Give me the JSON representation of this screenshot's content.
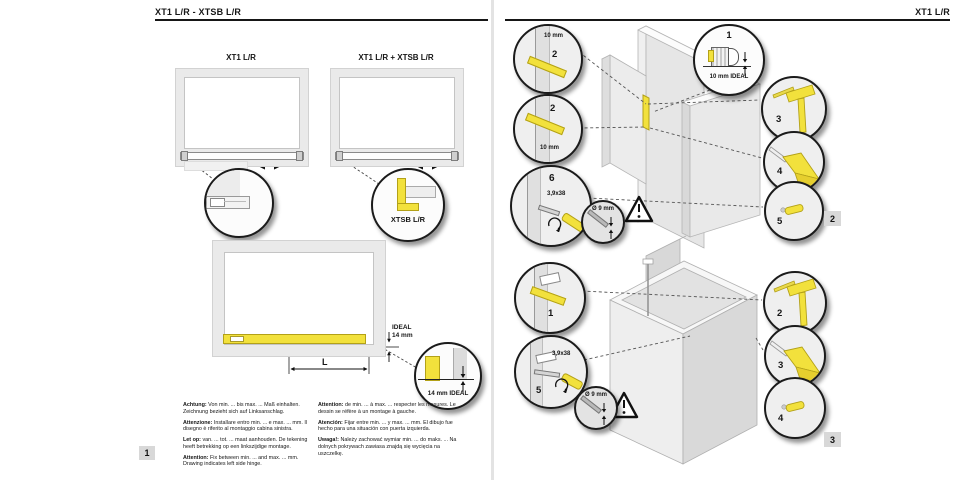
{
  "colors": {
    "accent_yellow": "#f2e13c",
    "yellow_border": "#b3a118",
    "panel_gray": "#eaeaea",
    "line": "#161616"
  },
  "left_page": {
    "header": "XT1 L/R - XTSB L/R",
    "step_number": "1",
    "figure1": {
      "title": "XT1 L/R"
    },
    "figure2": {
      "title": "XT1 L/R + XTSB L/R",
      "detail_label": "XTSB L/R"
    },
    "figure3": {
      "ideal_line1": "IDEAL",
      "ideal_line2": "14 mm",
      "length_label": "L",
      "detail_label": "14 mm IDEAL"
    },
    "notes_col1": [
      {
        "label": "Achtung:",
        "text": "Von min. ... bis max. ... Maß einhalten. Zeichnung bezieht sich auf Linksanschlag."
      },
      {
        "label": "Attenzione:",
        "text": "Installare entro min. ... e max. ... mm. Il disegno è riferito al montaggio cabina sinistra."
      },
      {
        "label": "Let op:",
        "text": "van. ... tot. ... maat aanhouden. De tekening heeft betrekking op een linkszijdige montage."
      },
      {
        "label": "Attention:",
        "text": "Fix between min. ... and max. ... mm. Drawing indicates left side hinge."
      }
    ],
    "notes_col2": [
      {
        "label": "Attention:",
        "text": "de min. ... à max. ... respecter les mesures. Le dessin se réfère à un montage à gauche."
      },
      {
        "label": "Atención:",
        "text": "Fijar entre min. ... y max. ... mm. El dibujo fue hecho para una situación con puerta izquierda."
      },
      {
        "label": "Uwaga!:",
        "text": "Należy zachować wymiar min. ... do maks. ... Na dolnych pokrywach zawiasa znajdą się wycięcia na uszczelkę."
      }
    ]
  },
  "right_page": {
    "header": "XT1 L/R",
    "step2": {
      "number": "2",
      "gap_top": {
        "dim": "10 mm",
        "part": "2"
      },
      "gap_bottom": {
        "part": "2",
        "dim": "10 mm"
      },
      "screw_detail": {
        "part": "6",
        "screw": "3,9x38"
      },
      "drill_detail": {
        "dim": "Ø 9 mm"
      },
      "profile_detail": {
        "part": "1",
        "dim": "10 mm IDEAL"
      },
      "tools": {
        "hammer": "3",
        "nozzle": "4",
        "part": "5"
      }
    },
    "step3": {
      "number": "3",
      "strip_detail": {
        "part": "1"
      },
      "screw_detail": {
        "part": "5",
        "screw": "3,9x38"
      },
      "drill_detail": {
        "dim": "Ø 9 mm"
      },
      "tools": {
        "hammer": "2",
        "nozzle": "3",
        "part": "4"
      }
    }
  }
}
